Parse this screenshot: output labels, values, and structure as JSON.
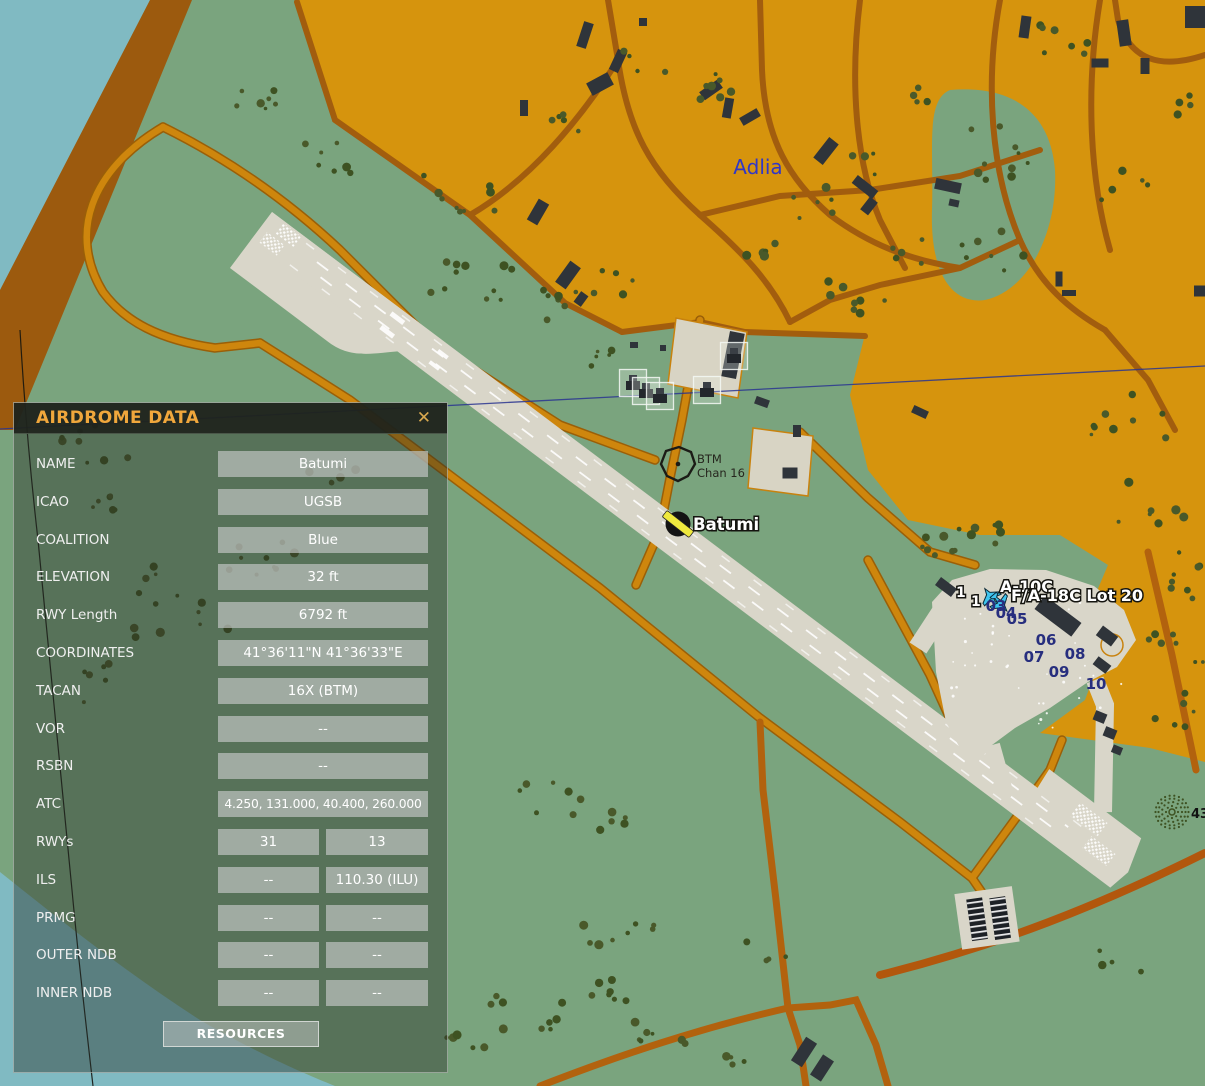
{
  "panel": {
    "title": "AIRDROME DATA",
    "close_label": "✕",
    "rows": [
      {
        "label": "NAME",
        "values": [
          "Batumi"
        ]
      },
      {
        "label": "ICAO",
        "values": [
          "UGSB"
        ]
      },
      {
        "label": "COALITION",
        "values": [
          "Blue"
        ]
      },
      {
        "label": "ELEVATION",
        "values": [
          "32 ft"
        ]
      },
      {
        "label": "RWY Length",
        "values": [
          "6792 ft"
        ]
      },
      {
        "label": "COORDINATES",
        "values": [
          "41°36'11\"N 41°36'33\"E"
        ]
      },
      {
        "label": "TACAN",
        "values": [
          "16X (BTM)"
        ]
      },
      {
        "label": "VOR",
        "values": [
          "--"
        ]
      },
      {
        "label": "RSBN",
        "values": [
          "--"
        ]
      },
      {
        "label": "ATC",
        "values": [
          "4.250, 131.000, 40.400, 260.000"
        ]
      },
      {
        "label": "RWYs",
        "values": [
          "31",
          "13"
        ]
      },
      {
        "label": "ILS",
        "values": [
          "--",
          "110.30 (ILU)"
        ]
      },
      {
        "label": "PRMG",
        "values": [
          "--",
          "--"
        ]
      },
      {
        "label": "OUTER NDB",
        "values": [
          "--",
          "--"
        ]
      },
      {
        "label": "INNER NDB",
        "values": [
          "--",
          "--"
        ]
      }
    ],
    "resources_button": "RESOURCES"
  },
  "map": {
    "town_label": "Adlia",
    "airfield_label": "Batumi",
    "beacon": {
      "name": "BTM",
      "channel": "Chan 16"
    },
    "units": [
      {
        "count": "1",
        "label": "A-10C"
      },
      {
        "count": "1",
        "label": "F/A-18C Lot 20"
      }
    ],
    "parking_spots": [
      "03",
      "04",
      "05",
      "06",
      "07",
      "08",
      "09",
      "10"
    ],
    "edge_label": "43",
    "colors": {
      "urban": "#D6940D",
      "terrain": "#7AA47E",
      "water": "#80BAC2",
      "runway": "#D9D6C9",
      "road_orange": "#CE860D",
      "road_brown": "#A25D0E",
      "label_blue": "#3137C6",
      "parking_blue": "#272E7E",
      "panel_accent": "#F0A73C",
      "unit_icon_cyan": "#3FC4EE"
    }
  }
}
